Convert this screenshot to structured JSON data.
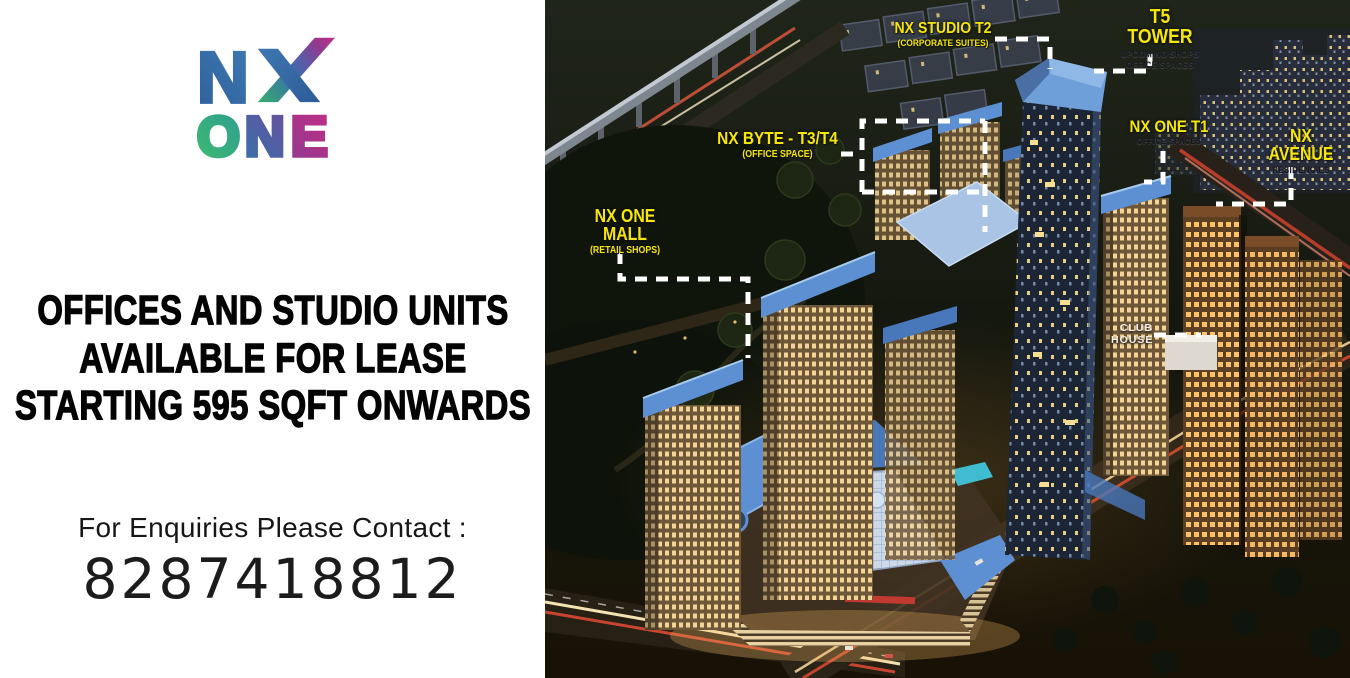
{
  "brand": {
    "logo_text": "NX ONE",
    "letter_n": "N",
    "letters_one": [
      "O",
      "N",
      "E"
    ],
    "colors": {
      "blue": "#3a6fa9",
      "green": "#35b06a",
      "teal": "#2f9e8f",
      "purple": "#6a4f9e",
      "violet": "#93398f",
      "magenta": "#c02e86"
    }
  },
  "left_panel": {
    "headline_lines": [
      "OFFICES AND STUDIO UNITS",
      "AVAILABLE FOR LEASE",
      "STARTING 595 SQFT ONWARDS"
    ],
    "contact_label": "For Enquiries Please Contact :",
    "phone": "8287418812"
  },
  "scene": {
    "label_color": "#f5e70a",
    "callout_color": "#ffffff",
    "labels": {
      "studio": {
        "title": "NX STUDIO T2",
        "subtitle": "(CORPORATE SUITES)"
      },
      "t5": {
        "title": "T5 TOWER",
        "subtitle1": "UPCOMING SHOPS",
        "subtitle2": "OFFICE SPACES"
      },
      "byte": {
        "title": "NX BYTE - T3/T4",
        "subtitle": "(OFFICE SPACE)"
      },
      "t1": {
        "title": "NX ONE T1",
        "subtitle": "OFFICE SPACES"
      },
      "avenue": {
        "title": "NX AVENUE",
        "subtitle": "RESIDENCIES"
      },
      "mall": {
        "title": "NX ONE MALL",
        "subtitle": "(RETAIL SHOPS)"
      },
      "club": {
        "line1": "CLUB",
        "line2": "HOUSE"
      }
    }
  }
}
